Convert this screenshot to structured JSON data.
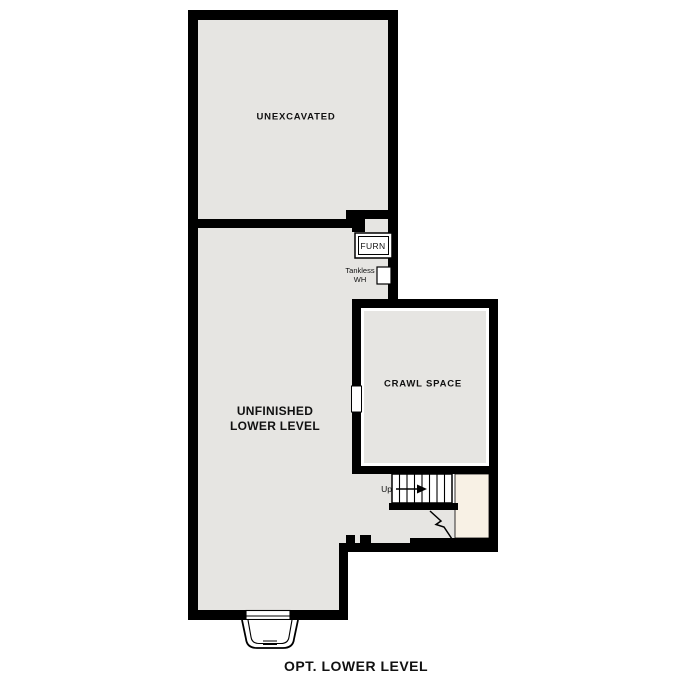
{
  "plan": {
    "caption": "OPT. LOWER LEVEL",
    "rooms": {
      "unexcavated": {
        "label": "UNEXCAVATED"
      },
      "unfinished_lower_level": {
        "label_line1": "UNFINISHED",
        "label_line2": "LOWER LEVEL"
      },
      "crawl_space": {
        "label": "CRAWL SPACE"
      }
    },
    "fixtures": {
      "furnace": {
        "label": "FURN"
      },
      "tankless_water_heater": {
        "label_line1": "Tankless",
        "label_line2": "WH"
      },
      "stairs": {
        "label": "Up",
        "direction": "up"
      }
    },
    "colors": {
      "wall": "#000000",
      "floor_fill": "#e6e5e2",
      "stair_landing_fill": "#f8f1e5",
      "background": "#ffffff",
      "text": "#111111"
    }
  }
}
